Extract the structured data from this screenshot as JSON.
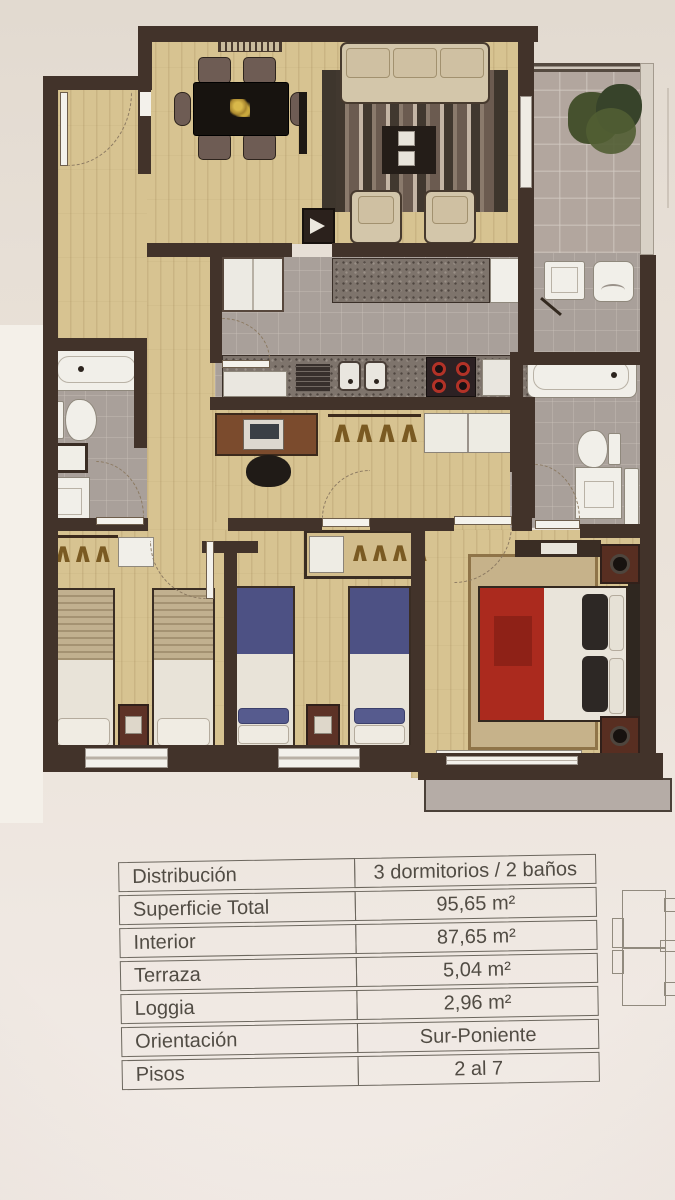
{
  "table": {
    "rows": [
      {
        "label": "Distribución",
        "value": "3 dormitorios / 2 baños"
      },
      {
        "label": "Superficie Total",
        "value": "95,65 m²"
      },
      {
        "label": "Interior",
        "value": "87,65 m²"
      },
      {
        "label": "Terraza",
        "value": "5,04 m²"
      },
      {
        "label": "Loggia",
        "value": "2,96 m²"
      },
      {
        "label": "Orientación",
        "value": "Sur-Poniente"
      },
      {
        "label": "Pisos",
        "value": "2 al 7"
      }
    ]
  },
  "plan": {
    "glyphs": {
      "hangers_hall": "∧∧∧∧∧∧",
      "hangers_bed2": "∧∧∧∧",
      "hangers_bed1": "∧∧∧"
    }
  },
  "colors": {
    "paper": "#e9e1d8",
    "wall": "#42332a",
    "wood_floor": "#d7c391",
    "tile_floor": "#a9a09a",
    "terrace_floor": "#b2a69e",
    "red_bed": "#ab2a1e",
    "blue_bed": "#4d5184",
    "sofa_beige": "#d3c6aa",
    "table_border": "#6c675e",
    "table_text": "#514c44"
  }
}
